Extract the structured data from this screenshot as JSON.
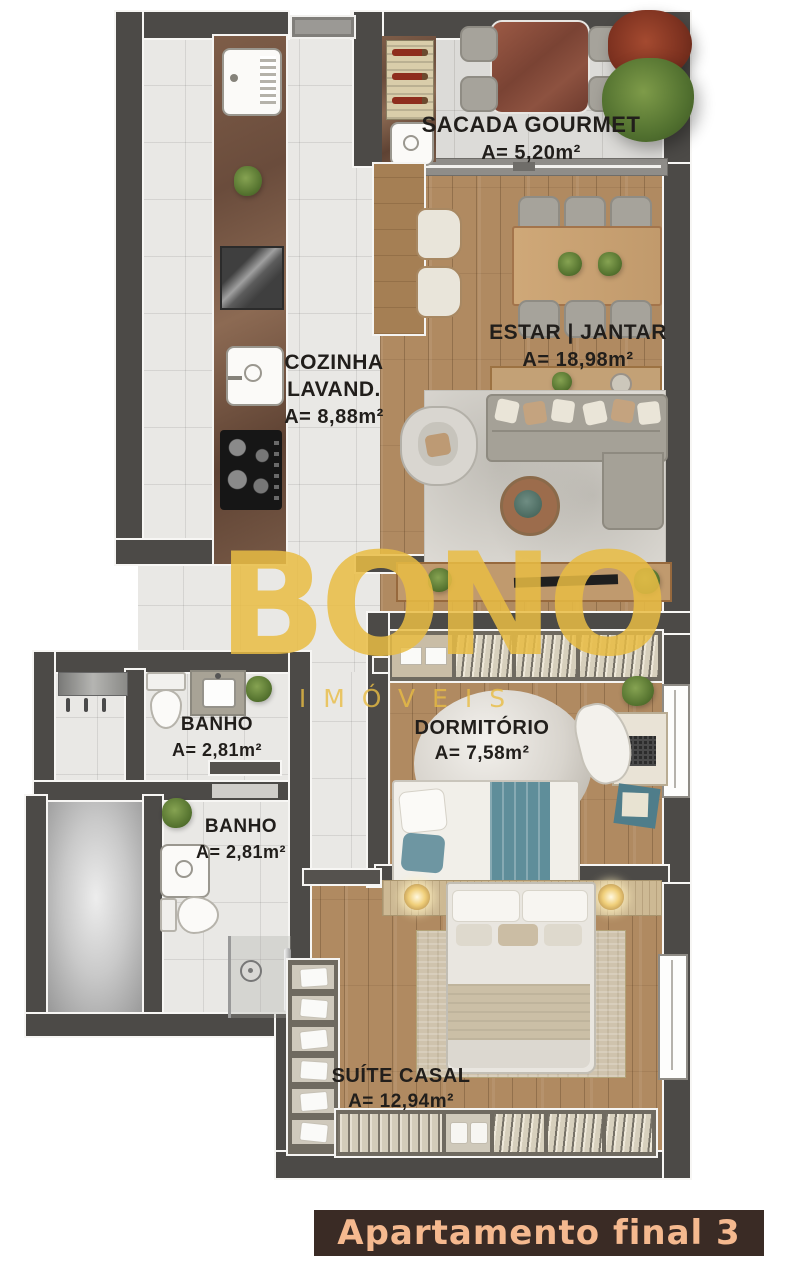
{
  "watermark": {
    "brand": "BONO",
    "subtitle": "IMÓVEIS",
    "color": "#e9bd44"
  },
  "footer": {
    "label": "Apartamento final 3",
    "background": "#3a2b25",
    "text_color": "#f5b98f"
  },
  "rooms": {
    "sacada_gourmet": {
      "name": "SACADA GOURMET",
      "area": "A= 5,20m²"
    },
    "estar_jantar": {
      "name": "ESTAR | JANTAR",
      "area": "A= 18,98m²"
    },
    "cozinha_lavand": {
      "name_line1": "COZINHA",
      "name_line2": "LAVAND.",
      "area": "A= 8,88m²"
    },
    "banho_1": {
      "name": "BANHO",
      "area": "A= 2,81m²"
    },
    "banho_2": {
      "name": "BANHO",
      "area": "A= 2,81m²"
    },
    "dormitorio": {
      "name": "DORMITÓRIO",
      "area": "A= 7,58m²"
    },
    "suite_casal": {
      "name": "SUÍTE CASAL",
      "area": "A= 12,94m²"
    }
  },
  "palette": {
    "wall": "#4c4a47",
    "tile_floor": "#e9e8e5",
    "wood_floor": "#b08a61",
    "counter_marble": "#6f5243",
    "accent_teal": "#5f8e9a",
    "label_text": "#211e1b"
  }
}
